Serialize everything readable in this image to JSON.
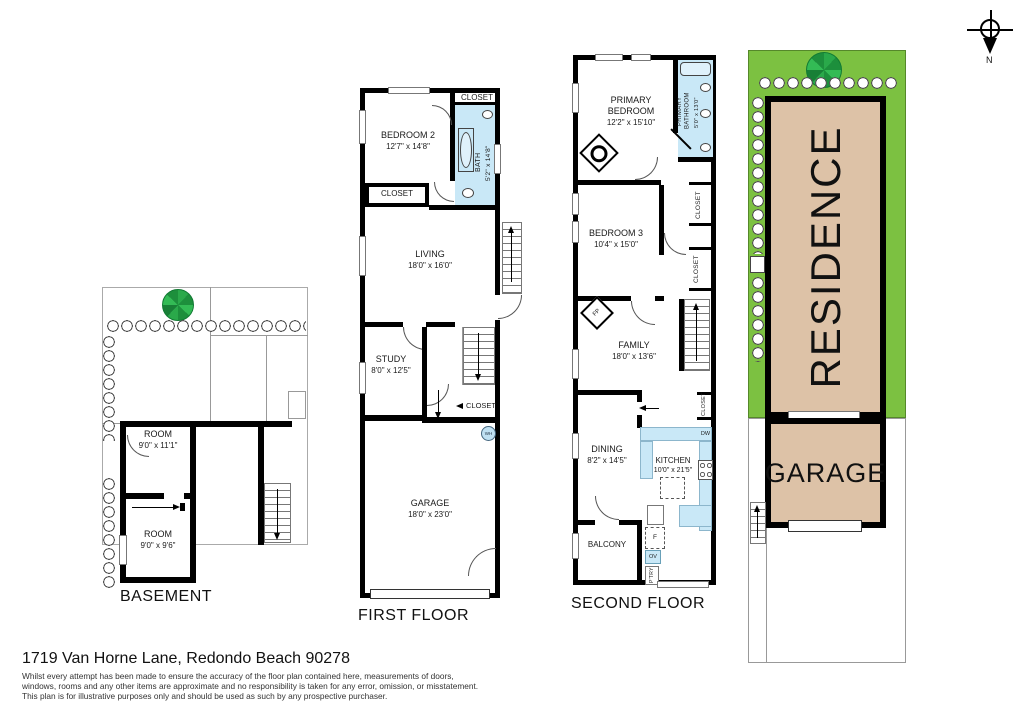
{
  "footer": {
    "address": "1719 Van Horne Lane, Redondo Beach 90278",
    "disclaimer1": "Whilst every attempt has been made to ensure the accuracy of the floor plan contained here, measurements of doors,",
    "disclaimer2": "windows, rooms and any other items are approximate and no responsibility is taken for any error, omission, or misstatement.",
    "disclaimer3": "This plan is for illustrative purposes only and should be used as such by any prospective purchaser."
  },
  "compass": {
    "north": "N"
  },
  "basement": {
    "title": "BASEMENT",
    "room_upper_name": "ROOM",
    "room_upper_dims": "9'0\" x 11'1\"",
    "room_lower_name": "ROOM",
    "room_lower_dims": "9'0\" x 9'6\""
  },
  "first_floor": {
    "title": "FIRST FLOOR",
    "bedroom2_name": "BEDROOM 2",
    "bedroom2_dims": "12'7\" x 14'8\"",
    "bath_name": "BATH",
    "bath_dims": "5'2\" x 14'8\"",
    "living_name": "LIVING",
    "living_dims": "18'0\" x 16'0\"",
    "study_name": "STUDY",
    "study_dims": "8'0\" x 12'5\"",
    "garage_name": "GARAGE",
    "garage_dims": "18'0\" x 23'0\"",
    "closet_top": "CLOSET",
    "closet_bedroom": "CLOSET",
    "closet_stairs": "CLOSET",
    "water_heater": "WH"
  },
  "second_floor": {
    "title": "SECOND FLOOR",
    "primary_bedroom_name": "PRIMARY BEDROOM",
    "primary_bedroom_dims": "12'2\" x 15'10\"",
    "primary_bathroom_name": "PRIMARY BATHROOM",
    "primary_bathroom_dims": "5'0\" x 13'0\"",
    "bedroom3_name": "BEDROOM 3",
    "bedroom3_dims": "10'4\" x 15'0\"",
    "family_name": "FAMILY",
    "family_dims": "18'0\" x 13'6\"",
    "dining_name": "DINING",
    "dining_dims": "8'2\" x 14'5\"",
    "kitchen_name": "KITCHEN",
    "kitchen_dims": "10'0\" x 21'5\"",
    "balcony_name": "BALCONY",
    "closet_primary": "CLOSET",
    "closet_bedroom3": "CLOSET",
    "closet_hall": "CLOSET",
    "fireplace": "FP",
    "fridge": "F",
    "oven": "OV",
    "pantry": "P'TRY",
    "dishwasher": "DW"
  },
  "site_plan": {
    "residence": "RESIDENCE",
    "garage": "GARAGE"
  },
  "colors": {
    "lot_green": "#7cc141",
    "building_tan": "#ddc2a7",
    "bath_blue": "#c9e8f7",
    "tree_green": "#2eb34d",
    "wall": "#000000"
  }
}
